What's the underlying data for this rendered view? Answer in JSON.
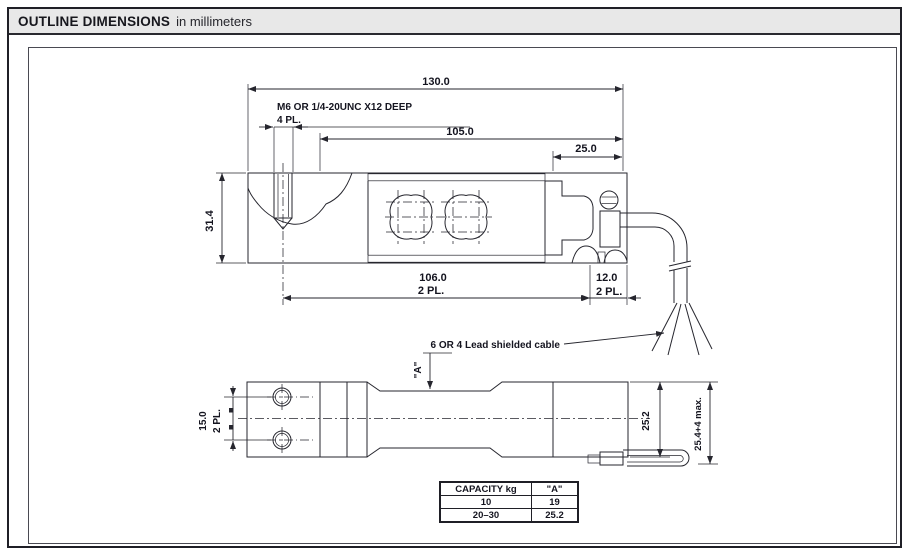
{
  "colors": {
    "line": "#26262e",
    "header_bg": "#e8e8e8",
    "paper": "#ffffff"
  },
  "header": {
    "title": "OUTLINE DIMENSIONS",
    "subtitle": "in millimeters"
  },
  "top_view": {
    "dim_overall_length": "130.0",
    "thread_note_line1": "M6 OR 1/4-20UNC X12 DEEP",
    "thread_note_line2": "4 PL.",
    "dim_mount_length": "105.0",
    "dim_end_width": "25.0",
    "dim_body_height": "31.4",
    "dim_hole_span": "106.0",
    "dim_hole_span_places": "2 PL.",
    "dim_cable_inset": "12.0",
    "dim_cable_inset_places": "2 PL.",
    "cable_note": "6 OR 4 Lead shielded cable"
  },
  "side_view": {
    "dim_hole_pitch": "15.0",
    "dim_hole_pitch_places": "2 PL.",
    "dim_a_ref": "\"A\"",
    "dim_end_height": "25.2",
    "dim_overall_height": "25.4+4 max."
  },
  "capacity_table": {
    "headers": [
      "CAPACITY kg",
      "\"A\""
    ],
    "rows": [
      [
        "10",
        "19"
      ],
      [
        "20–30",
        "25.2"
      ]
    ]
  }
}
